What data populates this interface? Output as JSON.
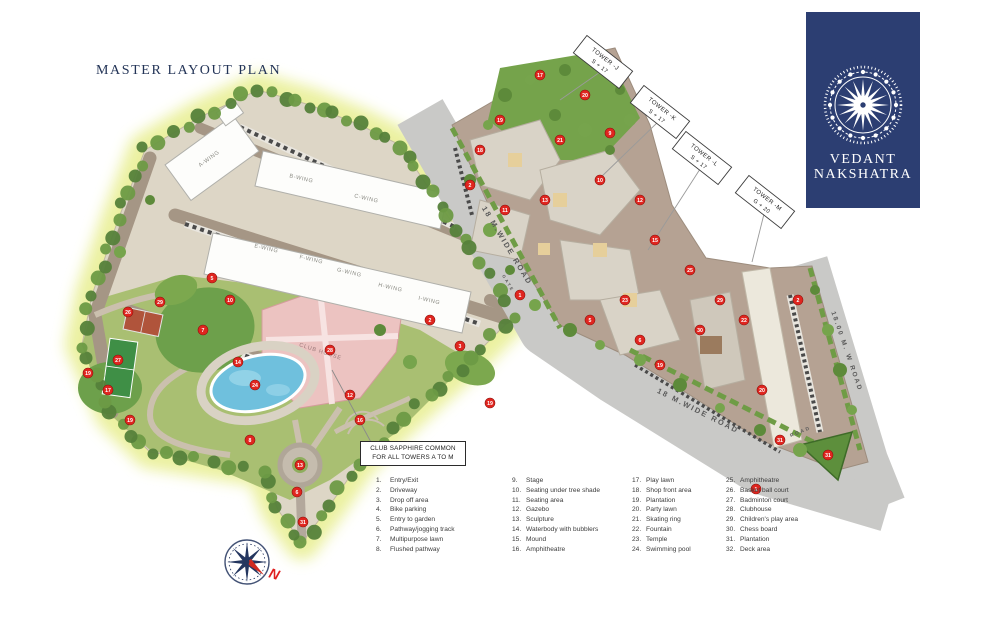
{
  "page": {
    "title": "MASTER LAYOUT PLAN"
  },
  "logo": {
    "line1": "VEDANT",
    "line2": "NAKSHATRA",
    "bg": "#2c3e72"
  },
  "map": {
    "callout": {
      "line1": "CLUB SAPPHIRE COMMON",
      "line2": "FOR ALL TOWERS A TO M"
    },
    "club_house_label": "CLUB HOUSE",
    "compass_letter": "N",
    "accent_colors": {
      "badge_red": "#e0251f",
      "road_gray": "#c9c9c7",
      "site_green": "#8fae5e",
      "pool_blue": "#6fc0dd",
      "clubhouse_pink": "#ecc3c1",
      "logo_navy": "#2c3e72"
    },
    "wing_labels": [
      {
        "text": "A-WING",
        "x": 210,
        "y": 160,
        "rot": -36
      },
      {
        "text": "B-WING",
        "x": 301,
        "y": 180,
        "rot": 13
      },
      {
        "text": "C-WING",
        "x": 366,
        "y": 200,
        "rot": 13
      },
      {
        "text": "E-WING",
        "x": 266,
        "y": 250,
        "rot": 13
      },
      {
        "text": "F-WING",
        "x": 311,
        "y": 261,
        "rot": 13
      },
      {
        "text": "G-WING",
        "x": 349,
        "y": 274,
        "rot": 13
      },
      {
        "text": "H-WING",
        "x": 390,
        "y": 289,
        "rot": 13
      },
      {
        "text": "I-WING",
        "x": 429,
        "y": 302,
        "rot": 13
      }
    ],
    "tower_labels": [
      {
        "line1": "TOWER -J",
        "line2": "S + 17",
        "x": 603,
        "y": 62,
        "rot": 38,
        "lx": 560,
        "ly": 100
      },
      {
        "line1": "TOWER -K",
        "line2": "S + 17",
        "x": 660,
        "y": 112,
        "rot": 38,
        "lx": 598,
        "ly": 180
      },
      {
        "line1": "TOWER -L",
        "line2": "S + 17",
        "x": 702,
        "y": 158,
        "rot": 38,
        "lx": 648,
        "ly": 250
      },
      {
        "line1": "TOWER -M",
        "line2": "G + 20",
        "x": 765,
        "y": 202,
        "rot": 38,
        "lx": 752,
        "ly": 262
      }
    ],
    "road_labels": [
      {
        "text": "18 M.WIDE ROAD",
        "x": 505,
        "y": 247,
        "rot": 59,
        "size": 7.5
      },
      {
        "text": "18 M.WIDE ROAD",
        "x": 697,
        "y": 413,
        "rot": 27,
        "size": 7.5
      },
      {
        "text": "18.00 M. W ROAD",
        "x": 845,
        "y": 352,
        "rot": 71,
        "size": 6.5
      },
      {
        "text": "ROAD",
        "x": 801,
        "y": 433,
        "rot": -22,
        "size": 4.8
      },
      {
        "text": "GATE",
        "x": 507,
        "y": 284,
        "rot": 59,
        "size": 4.2
      }
    ],
    "markers": [
      {
        "x": 520,
        "y": 295,
        "n": "1"
      },
      {
        "x": 756,
        "y": 489,
        "n": "1"
      },
      {
        "x": 430,
        "y": 320,
        "n": "2"
      },
      {
        "x": 470,
        "y": 185,
        "n": "2"
      },
      {
        "x": 798,
        "y": 300,
        "n": "2"
      },
      {
        "x": 460,
        "y": 346,
        "n": "3"
      },
      {
        "x": 212,
        "y": 278,
        "n": "5"
      },
      {
        "x": 590,
        "y": 320,
        "n": "5"
      },
      {
        "x": 297,
        "y": 492,
        "n": "6"
      },
      {
        "x": 640,
        "y": 340,
        "n": "6"
      },
      {
        "x": 203,
        "y": 330,
        "n": "7"
      },
      {
        "x": 250,
        "y": 440,
        "n": "8"
      },
      {
        "x": 610,
        "y": 133,
        "n": "9"
      },
      {
        "x": 230,
        "y": 300,
        "n": "10"
      },
      {
        "x": 600,
        "y": 180,
        "n": "10"
      },
      {
        "x": 505,
        "y": 210,
        "n": "11"
      },
      {
        "x": 350,
        "y": 395,
        "n": "12"
      },
      {
        "x": 640,
        "y": 200,
        "n": "12"
      },
      {
        "x": 300,
        "y": 465,
        "n": "13"
      },
      {
        "x": 545,
        "y": 200,
        "n": "13"
      },
      {
        "x": 238,
        "y": 362,
        "n": "14"
      },
      {
        "x": 655,
        "y": 240,
        "n": "15"
      },
      {
        "x": 360,
        "y": 420,
        "n": "16"
      },
      {
        "x": 108,
        "y": 390,
        "n": "17"
      },
      {
        "x": 540,
        "y": 75,
        "n": "17"
      },
      {
        "x": 480,
        "y": 150,
        "n": "18"
      },
      {
        "x": 88,
        "y": 373,
        "n": "19"
      },
      {
        "x": 130,
        "y": 420,
        "n": "19"
      },
      {
        "x": 500,
        "y": 120,
        "n": "19"
      },
      {
        "x": 660,
        "y": 365,
        "n": "19"
      },
      {
        "x": 490,
        "y": 403,
        "n": "19"
      },
      {
        "x": 585,
        "y": 95,
        "n": "20"
      },
      {
        "x": 762,
        "y": 390,
        "n": "20"
      },
      {
        "x": 560,
        "y": 140,
        "n": "21"
      },
      {
        "x": 744,
        "y": 320,
        "n": "22"
      },
      {
        "x": 625,
        "y": 300,
        "n": "23"
      },
      {
        "x": 255,
        "y": 385,
        "n": "24"
      },
      {
        "x": 690,
        "y": 270,
        "n": "25"
      },
      {
        "x": 128,
        "y": 312,
        "n": "26"
      },
      {
        "x": 118,
        "y": 360,
        "n": "27"
      },
      {
        "x": 330,
        "y": 350,
        "n": "28"
      },
      {
        "x": 160,
        "y": 302,
        "n": "29"
      },
      {
        "x": 720,
        "y": 300,
        "n": "29"
      },
      {
        "x": 700,
        "y": 330,
        "n": "30"
      },
      {
        "x": 303,
        "y": 522,
        "n": "31"
      },
      {
        "x": 828,
        "y": 455,
        "n": "31"
      },
      {
        "x": 780,
        "y": 440,
        "n": "31"
      }
    ]
  },
  "legend": {
    "columns": [
      [
        {
          "n": "1.",
          "label": "Entry/Exit"
        },
        {
          "n": "2.",
          "label": "Driveway"
        },
        {
          "n": "3.",
          "label": "Drop off area"
        },
        {
          "n": "4.",
          "label": "Bike parking"
        },
        {
          "n": "5.",
          "label": "Entry to garden"
        },
        {
          "n": "6.",
          "label": "Pathway/jogging track"
        },
        {
          "n": "7.",
          "label": "Multipurpose lawn"
        },
        {
          "n": "8.",
          "label": "Flushed pathway"
        }
      ],
      [
        {
          "n": "9.",
          "label": "Stage"
        },
        {
          "n": "10.",
          "label": "Seating under tree shade"
        },
        {
          "n": "11.",
          "label": "Seating area"
        },
        {
          "n": "12.",
          "label": "Gazebo"
        },
        {
          "n": "13.",
          "label": "Sculpture"
        },
        {
          "n": "14.",
          "label": "Waterbody with bubblers"
        },
        {
          "n": "15.",
          "label": "Mound"
        },
        {
          "n": "16.",
          "label": "Amphitheatre"
        }
      ],
      [
        {
          "n": "17.",
          "label": "Play lawn"
        },
        {
          "n": "18.",
          "label": "Shop front area"
        },
        {
          "n": "19.",
          "label": "Plantation"
        },
        {
          "n": "20.",
          "label": "Party lawn"
        },
        {
          "n": "21.",
          "label": "Skating ring"
        },
        {
          "n": "22.",
          "label": "Fountain"
        },
        {
          "n": "23.",
          "label": "Temple"
        },
        {
          "n": "24.",
          "label": "Swimming pool"
        }
      ],
      [
        {
          "n": "25.",
          "label": "Amphitheatre"
        },
        {
          "n": "26.",
          "label": "Basket ball court"
        },
        {
          "n": "27.",
          "label": "Badminton court"
        },
        {
          "n": "28.",
          "label": "Clubhouse"
        },
        {
          "n": "29.",
          "label": "Children's play area"
        },
        {
          "n": "30.",
          "label": "Chess board"
        },
        {
          "n": "31.",
          "label": "Plantation"
        },
        {
          "n": "32.",
          "label": "Deck area"
        }
      ]
    ]
  }
}
